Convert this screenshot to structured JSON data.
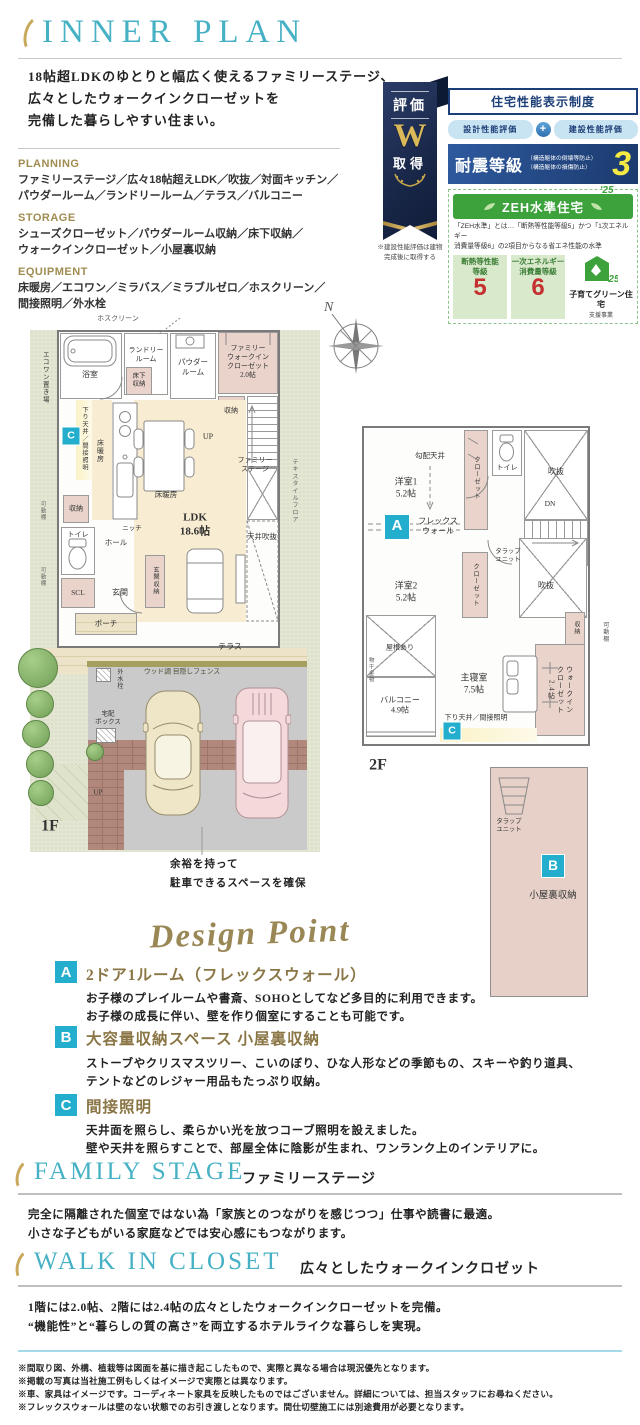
{
  "header": {
    "title": "INNER PLAN",
    "intro": "18帖超LDKのゆとりと幅広く使えるファミリーステージ、\n広々としたウォークインクローゼットを\n完備した暮らしやすい住まい。"
  },
  "specs": [
    {
      "label": "PLANNING",
      "text": "ファミリーステージ／広々18帖超えLDK／吹抜／対面キッチン／\nパウダールーム／ランドリールーム／テラス／バルコニー"
    },
    {
      "label": "STORAGE",
      "text": "シューズクローゼット／パウダールーム収納／床下収納／\nウォークインクローゼット／小屋裏収納"
    },
    {
      "label": "EQUIPMENT",
      "text": "床暖房／エコワン／ミラバス／ミラブルゼロ／ホスクリーン／\n間接照明／外水栓"
    }
  ],
  "award": {
    "ribbon": {
      "top": "評価",
      "letter": "W",
      "bottom": "取得",
      "note": "※建設性能評価は建物\n完成後に取得する"
    },
    "card": {
      "title": "住宅性能表示制度",
      "pill_left": "設計性能評価",
      "plus": "+",
      "pill_right": "建設性能評価",
      "quake": {
        "label": "耐震等級",
        "sub1": "（構造躯体の倒壊等防止）",
        "sub2": "（構造躯体の損傷防止）",
        "grade": "3"
      },
      "zeh": {
        "bar": "ZEH水準住宅",
        "note": "「ZEH水準」とは…「断熱等性能等級5」かつ「1次エネルギー\n消費量等級6」の2項目からなる省エネ性能の水準",
        "box1_label": "断熱等性能\n等級",
        "box1_value": "5",
        "box2_label": "一次エネルギー\n消費量等級",
        "box2_value": "6",
        "badge_year": "'25",
        "badge_name": "子育てグリーン住宅",
        "badge_sub": "支援事業"
      }
    }
  },
  "plans": {
    "compass": "N",
    "parking_note": "余裕を持って\n駐車できるスペースを確保",
    "f1_labels": [
      {
        "t": "ホスクリーン",
        "x": 88,
        "y": 4,
        "s": 7,
        "c": "#555"
      },
      {
        "t": "エコワン置き場",
        "x": 14,
        "y": 62,
        "v": 1,
        "s": 6.5
      },
      {
        "t": "浴室",
        "x": 60,
        "y": 60,
        "s": 8
      },
      {
        "t": "ランドリー\nルーム",
        "x": 116,
        "y": 40,
        "s": 7
      },
      {
        "t": "床下\n収納",
        "x": 109,
        "y": 66,
        "s": 6.5
      },
      {
        "t": "パウダー\nルーム",
        "x": 163,
        "y": 52,
        "s": 7.5
      },
      {
        "t": "ファミリー\nウォークイン\nクローゼット\n2.0帖",
        "x": 218,
        "y": 47,
        "s": 7
      },
      {
        "t": "収納",
        "x": 201,
        "y": 96,
        "s": 7
      },
      {
        "t": "UP",
        "x": 178,
        "y": 122,
        "s": 8
      },
      {
        "t": "下り天井／間接照明",
        "x": 54,
        "y": 124,
        "v": 1,
        "s": 6.2
      },
      {
        "t": "床暖房",
        "x": 70,
        "y": 136,
        "v": 1,
        "s": 7
      },
      {
        "t": "床暖房",
        "x": 136,
        "y": 180,
        "s": 7.5
      },
      {
        "t": "LDK\n18.6帖",
        "x": 165,
        "y": 210,
        "s": 11,
        "f": 1
      },
      {
        "t": "天井吹抜",
        "x": 232,
        "y": 222,
        "s": 7.5
      },
      {
        "t": "ファミリー\nステージ",
        "x": 225,
        "y": 150,
        "s": 7
      },
      {
        "t": "テキスタイルフロア",
        "x": 264,
        "y": 176,
        "v": 1,
        "s": 6.2,
        "c": "#666"
      },
      {
        "t": "可動棚",
        "x": 12,
        "y": 196,
        "v": 1,
        "s": 5.5,
        "c": "#666"
      },
      {
        "t": "可動棚",
        "x": 12,
        "y": 262,
        "v": 1,
        "s": 5.5,
        "c": "#666"
      },
      {
        "t": "収納",
        "x": 46,
        "y": 194,
        "s": 7
      },
      {
        "t": "ニッチ",
        "x": 102,
        "y": 214,
        "s": 6.5
      },
      {
        "t": "ホール",
        "x": 86,
        "y": 228,
        "s": 7.5
      },
      {
        "t": "トイレ",
        "x": 48,
        "y": 220,
        "s": 7
      },
      {
        "t": "SCL",
        "x": 48,
        "y": 278,
        "s": 7.5
      },
      {
        "t": "玄関",
        "x": 90,
        "y": 278,
        "s": 8
      },
      {
        "t": "玄関収納",
        "x": 125,
        "y": 266,
        "v": 1,
        "s": 6.2
      },
      {
        "t": "ポーチ",
        "x": 76,
        "y": 309,
        "s": 7.5
      },
      {
        "t": "テラス",
        "x": 200,
        "y": 332,
        "s": 8
      },
      {
        "t": "ウッド調 目隠しフェンス",
        "x": 152,
        "y": 358,
        "s": 6.8,
        "c": "#4d4b35"
      },
      {
        "t": "外水栓",
        "x": 88,
        "y": 364,
        "v": 1,
        "s": 6
      },
      {
        "t": "宅配\nボックス",
        "x": 78,
        "y": 404,
        "s": 6.5
      },
      {
        "t": "UP",
        "x": 68,
        "y": 478,
        "s": 7
      },
      {
        "t": "1F",
        "x": 20,
        "y": 512,
        "s": 16,
        "f": 1
      },
      {
        "t": "C",
        "x": 41,
        "y": 121,
        "b": 1
      }
    ],
    "f2_labels": [
      {
        "t": "勾配天井",
        "x": 70,
        "y": 76,
        "s": 7.5
      },
      {
        "t": "洋室1\n5.2帖",
        "x": 46,
        "y": 108,
        "s": 9
      },
      {
        "t": "クローゼット",
        "x": 116,
        "y": 98,
        "v": 1,
        "s": 6.3
      },
      {
        "t": "トイレ",
        "x": 147,
        "y": 88,
        "s": 7
      },
      {
        "t": "吹抜",
        "x": 196,
        "y": 92,
        "s": 8
      },
      {
        "t": "DN",
        "x": 190,
        "y": 124,
        "s": 7.5
      },
      {
        "t": "タラップ\nユニット",
        "x": 148,
        "y": 176,
        "s": 6.3
      },
      {
        "t": "A",
        "x": 37,
        "y": 147,
        "b": 1,
        "bs": 24
      },
      {
        "t": "フレックス\nウォール",
        "x": 78,
        "y": 147,
        "s": 8
      },
      {
        "t": "洋室2\n5.2帖",
        "x": 46,
        "y": 212,
        "s": 9
      },
      {
        "t": "クローゼット",
        "x": 115,
        "y": 205,
        "v": 1,
        "s": 6.3
      },
      {
        "t": "吹抜",
        "x": 186,
        "y": 206,
        "s": 8
      },
      {
        "t": "収納",
        "x": 215,
        "y": 248,
        "v": 1,
        "s": 6
      },
      {
        "t": "可動棚",
        "x": 244,
        "y": 252,
        "v": 1,
        "s": 6,
        "c": "#555"
      },
      {
        "t": "物干金物",
        "x": 10,
        "y": 290,
        "v": 1,
        "s": 5.5,
        "c": "#555"
      },
      {
        "t": "屋根あり",
        "x": 40,
        "y": 268,
        "s": 7
      },
      {
        "t": "バルコニー\n4.9帖",
        "x": 40,
        "y": 326,
        "s": 8
      },
      {
        "t": "主寝室\n7.5帖",
        "x": 114,
        "y": 304,
        "s": 9
      },
      {
        "t": "ウォークイン\nクローゼット\n2.4帖",
        "x": 200,
        "y": 310,
        "v": 1,
        "s": 7
      },
      {
        "t": "下り天井／間接照明",
        "x": 116,
        "y": 338,
        "s": 7
      },
      {
        "t": "C",
        "x": 92,
        "y": 351,
        "b": 1
      },
      {
        "t": "2F",
        "x": 18,
        "y": 386,
        "s": 16,
        "f": 1
      }
    ],
    "attic_labels": [
      {
        "t": "タラップ\nユニット",
        "x": 18,
        "y": 58,
        "s": 6.3
      },
      {
        "t": "B",
        "x": 62,
        "y": 98,
        "b": 1,
        "bs": 22
      },
      {
        "t": "小屋裏収納",
        "x": 62,
        "y": 128,
        "s": 9.5
      }
    ]
  },
  "design": {
    "heading": "Design Point",
    "points": [
      {
        "letter": "A",
        "title": "2ドア1ルーム（フレックスウォール）",
        "lines": [
          "お子様のプレイルームや書斎、SOHOとしてなど多目的に利用できます。",
          "お子様の成長に伴い、壁を作り個室にすることも可能です。"
        ]
      },
      {
        "letter": "B",
        "title": "大容量収納スペース 小屋裏収納",
        "lines": [
          "ストーブやクリスマスツリー、こいのぼり、ひな人形などの季節もの、スキーや釣り道具、",
          "テントなどのレジャー用品もたっぷり収納。"
        ]
      },
      {
        "letter": "C",
        "title": "間接照明",
        "lines": [
          "天井面を照らし、柔らかい光を放つコーブ照明を設えました。",
          "壁や天井を照らすことで、部屋全体に陰影が生まれ、ワンランク上のインテリアに。"
        ]
      }
    ]
  },
  "family_stage": {
    "en": "FAMILY STAGE",
    "jp": "ファミリーステージ",
    "lines": [
      "完全に隔離された個室ではない為「家族とのつながりを感じつつ」仕事や読書に最適。",
      "小さな子どもがいる家庭などでは安心感にもつながります。"
    ]
  },
  "walk_in_closet": {
    "en": "WALK IN CLOSET",
    "jp": "広々としたウォークインクロゼット",
    "lines": [
      "1階には2.0帖、2階には2.4帖の広々としたウォークインクローゼットを完備。",
      "“機能性”と“暮らしの質の高さ”を両立するホテルライクな暮らしを実現。"
    ]
  },
  "footer": {
    "lines": [
      "※間取り図、外構、植栽等は図面を基に描き起こしたもので、実際と異なる場合は現況優先となります。",
      "※掲載の写真は当社施工例もしくはイメージで実際とは異なります。",
      "※車、家具はイメージです。コーディネート家具を反映したものではございません。詳細については、担当スタッフにお尋ねください。",
      "※フレックスウォールは壁のない状態でのお引き渡しとなります。間仕切壁施工には別途費用が必要となります。"
    ]
  }
}
